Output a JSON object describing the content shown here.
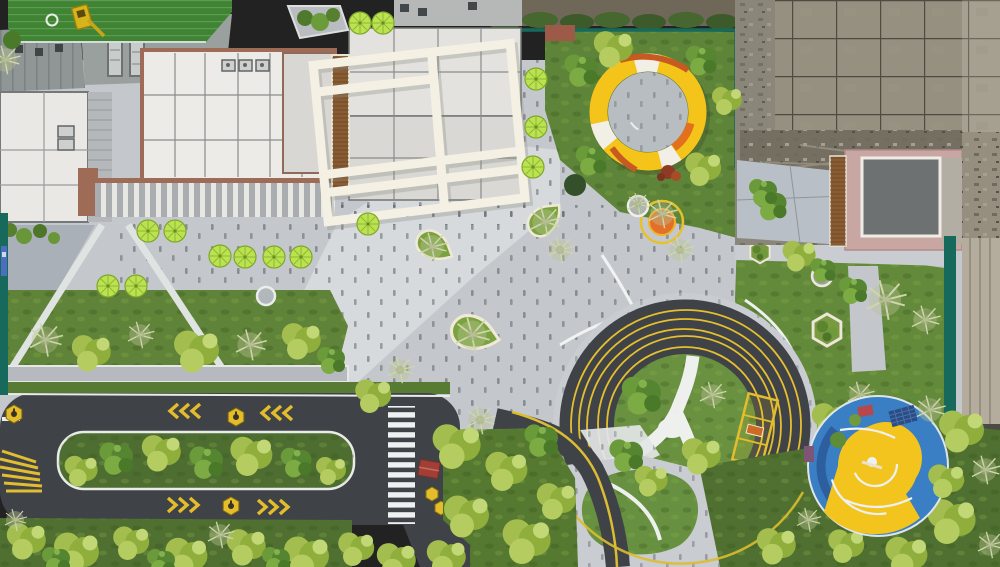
{
  "scene": {
    "type": "aerial-photograph",
    "subject": "landscaped residential plaza with circular playgrounds, running loop road and construction site"
  },
  "markings": {
    "station_hexagon_label": "S"
  },
  "palette": {
    "paving_base": "#c4c8cd",
    "paving_light": "#d7dadd",
    "paving_mid": "#aab0b7",
    "paver_joint": "#4b5158",
    "asphalt": "#3f4347",
    "marking_yellow": "#e5bf2d",
    "marking_white": "#eef0f0",
    "lawn_green": "#5f8338",
    "dark_lawn": "#4f7030",
    "turf_green": "#3e8433",
    "tree_green": "#5b8a31",
    "tree_yellow_green": "#9ab648",
    "twiggy_pale": "#c2cb9e",
    "umbrella_lime": "#bbe24f",
    "canopy_yellow": "#f5c41b",
    "canopy_orange": "#e2701d",
    "shrub_red": "#8e3a24",
    "playground_blue": "#3a7ec3",
    "playground_yellow": "#f2c41d",
    "playground_red": "#b8474b",
    "fence_teal": "#17695c",
    "roof_white": "#ecebe7",
    "roof_gray": "#979c9c",
    "roof_edge_red": "#9d6b56",
    "building_pink": "#c8a7a3",
    "louver_brown": "#8a5c33",
    "frame_white": "#f4f0e3",
    "demolition_gray": "#8b867a"
  },
  "elements": [
    "residential-building-rooftops",
    "white-pergola-frame-structure",
    "lime-green-parasols",
    "yellow-ring-canopy-pavilion",
    "circular-lawn-mound-with-yellow-track-rings",
    "blue-and-yellow-playground-circle",
    "running-loop-road-with-yellow-chevrons",
    "zebra-crosswalk",
    "hexagon-station-marking-S",
    "teardrop-planters",
    "hexagon-planters",
    "lawn-terraces-and-trees",
    "construction-hoarding-fence",
    "demolition-site",
    "pink-roofed-building",
    "putting-green-turf",
    "yellow-excavator"
  ]
}
